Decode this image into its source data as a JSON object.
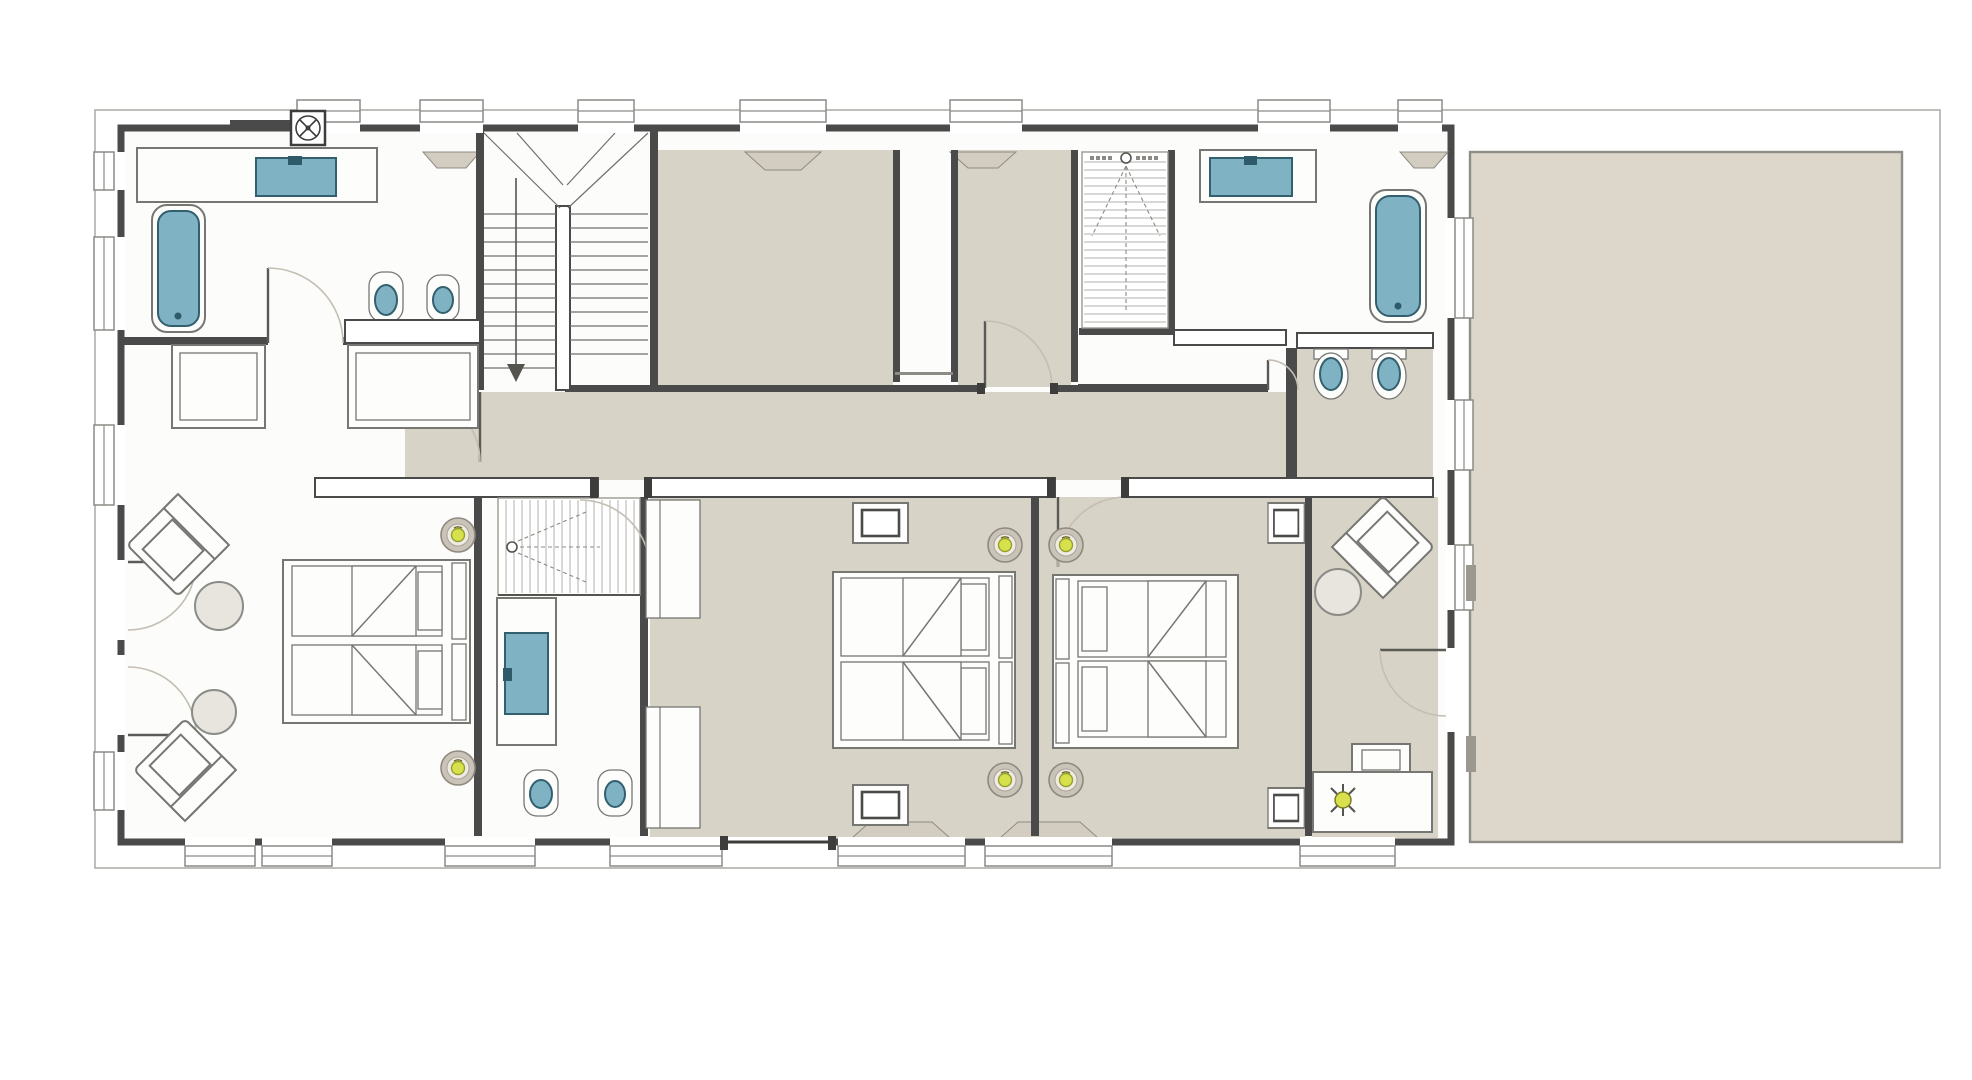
{
  "meta": {
    "drawing_type": "architectural floor plan, colored presentation style",
    "visible_text": "none legible (only micro tick marks on shower tiles)",
    "orientation": "building on left, open terrace on right"
  },
  "palette": {
    "paper": "#ffffff",
    "wall": "#4a4a4a",
    "room_floor_beige": "#d8d3c7",
    "terrace_beige": "#dcd7ca",
    "white_room_floor": "#fcfcfa",
    "sanitary_blue": "#7fb3c4",
    "sanitary_blue_dark": "#33606f",
    "ceiling_lamp_yellow": "#d7e14b",
    "furniture_outline": "#767672",
    "door_arc": "#c4beb3"
  },
  "rooms": [
    {
      "name": "bathroom-west",
      "floor": "white",
      "fixtures": [
        "vanity with basin",
        "bathtub",
        "wc",
        "bidet",
        "extractor-fan"
      ]
    },
    {
      "name": "main-staircase",
      "type": "U-shaped stair with down arrow"
    },
    {
      "name": "dressing-room-a",
      "floor": "beige"
    },
    {
      "name": "dressing-room-b",
      "floor": "beige"
    },
    {
      "name": "walk-in-shower-east",
      "type": "striped shower tray with shower-head symbol"
    },
    {
      "name": "bathroom-east",
      "floor": "white",
      "fixtures": [
        "vanity with basin",
        "bathtub"
      ]
    },
    {
      "name": "wc-east",
      "floor": "beige",
      "fixtures": [
        "wc",
        "bidet"
      ]
    },
    {
      "name": "hallway",
      "floor": "beige"
    },
    {
      "name": "bedroom-west",
      "floor": "white",
      "furniture": [
        "double bed (2 mattresses)",
        "2 armchairs",
        "2 round tables",
        "2 wardrobes"
      ]
    },
    {
      "name": "bathroom-middle",
      "floor": "white",
      "fixtures": [
        "walk-in shower",
        "vanity with basin",
        "wc",
        "bidet"
      ]
    },
    {
      "name": "bedroom-middle-left",
      "floor": "beige",
      "furniture": [
        "double bed",
        "2 bedside tables",
        "2 closets"
      ]
    },
    {
      "name": "bedroom-middle-right",
      "floor": "beige",
      "furniture": [
        "double bed",
        "2 bedside tables"
      ]
    },
    {
      "name": "bedroom-east",
      "floor": "beige",
      "furniture": [
        "armchair",
        "round table",
        "desk with chair and lamp"
      ]
    },
    {
      "name": "terrace",
      "floor": "beige",
      "position": "right of building"
    }
  ],
  "symbol_counts": {
    "ceiling_lights": 6,
    "bathtubs": 2,
    "wash_basins": 3,
    "wall_hung_wcs_and_bidets": 6,
    "showers": 2,
    "staircases": 1,
    "door_swings": 9,
    "armchairs": 3,
    "beds": 3
  }
}
